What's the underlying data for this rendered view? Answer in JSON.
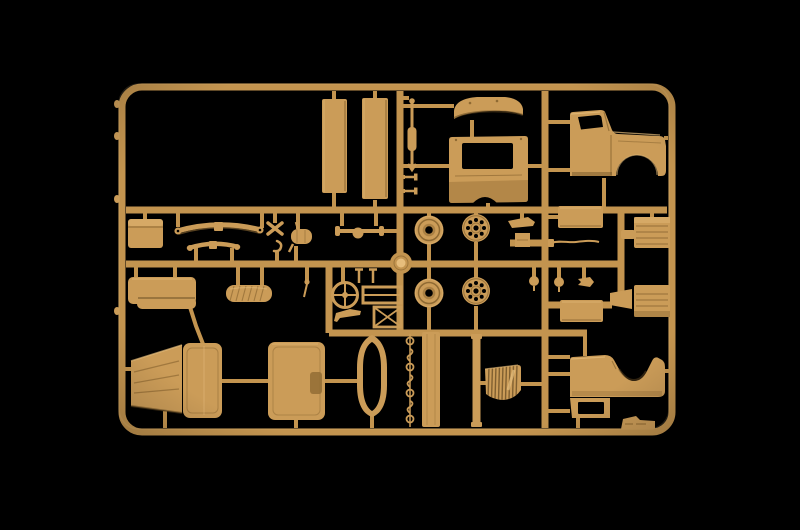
{
  "scene": {
    "description": "Photograph of a tan injection-molded plastic model kit sprue (truck parts frame) on a black background",
    "background": "#000000",
    "lighting": "soft center light with dark vignette at edges"
  },
  "palette": {
    "bg": "#000000",
    "plastic": "#cb9c58",
    "plastic_light": "#e6bd7c",
    "plastic_dark": "#8f6a33",
    "plastic_deep": "#5f461f",
    "runner": "#c3944f"
  },
  "sprue": {
    "material": "tan styrene plastic",
    "frame_shape": "rounded rectangle with internal runner bars",
    "parts": [
      {
        "name": "cargo-bed-side-panel",
        "count": 2
      },
      {
        "name": "steering-linkage-rod",
        "count": 1
      },
      {
        "name": "linkage-pin",
        "count": 2
      },
      {
        "name": "cab-roof-panel",
        "count": 1
      },
      {
        "name": "cab-rear-panel",
        "count": 1
      },
      {
        "name": "cab-side-panel",
        "count": 2
      },
      {
        "name": "stowage-box",
        "count": 1
      },
      {
        "name": "leaf-spring",
        "count": 2
      },
      {
        "name": "shackle-cross",
        "count": 1
      },
      {
        "name": "tow-hook",
        "count": 1
      },
      {
        "name": "exhaust-muffler",
        "count": 1
      },
      {
        "name": "front-axle",
        "count": 1
      },
      {
        "name": "road-wheel-tire",
        "count": 2
      },
      {
        "name": "wheel-hub",
        "count": 2
      },
      {
        "name": "sprue-gate-disc",
        "count": 1
      },
      {
        "name": "mounting-bracket",
        "count": 1
      },
      {
        "name": "cargo-flat-panel",
        "count": 2
      },
      {
        "name": "brake-line",
        "count": 1
      },
      {
        "name": "engine-block-half",
        "count": 2
      },
      {
        "name": "ball-joint",
        "count": 2
      },
      {
        "name": "arrow-bracket",
        "count": 1
      },
      {
        "name": "steering-wheel",
        "count": 1
      },
      {
        "name": "pedal-lever",
        "count": 2
      },
      {
        "name": "seat-frame",
        "count": 1
      },
      {
        "name": "frame-x-brace",
        "count": 1
      },
      {
        "name": "angle-bracket",
        "count": 1
      },
      {
        "name": "gear-lever",
        "count": 1
      },
      {
        "name": "bench-seat",
        "count": 1
      },
      {
        "name": "canvas-roll",
        "count": 1
      },
      {
        "name": "engine-hood-panel",
        "count": 1
      },
      {
        "name": "cab-door",
        "count": 2
      },
      {
        "name": "windshield-frame",
        "count": 1
      },
      {
        "name": "hook-and-ring-chain",
        "count": 1
      },
      {
        "name": "stake-side-panel",
        "count": 1
      },
      {
        "name": "stake-post",
        "count": 1
      },
      {
        "name": "radiator-grille",
        "count": 1
      },
      {
        "name": "molding-tab",
        "count": 1
      }
    ]
  }
}
